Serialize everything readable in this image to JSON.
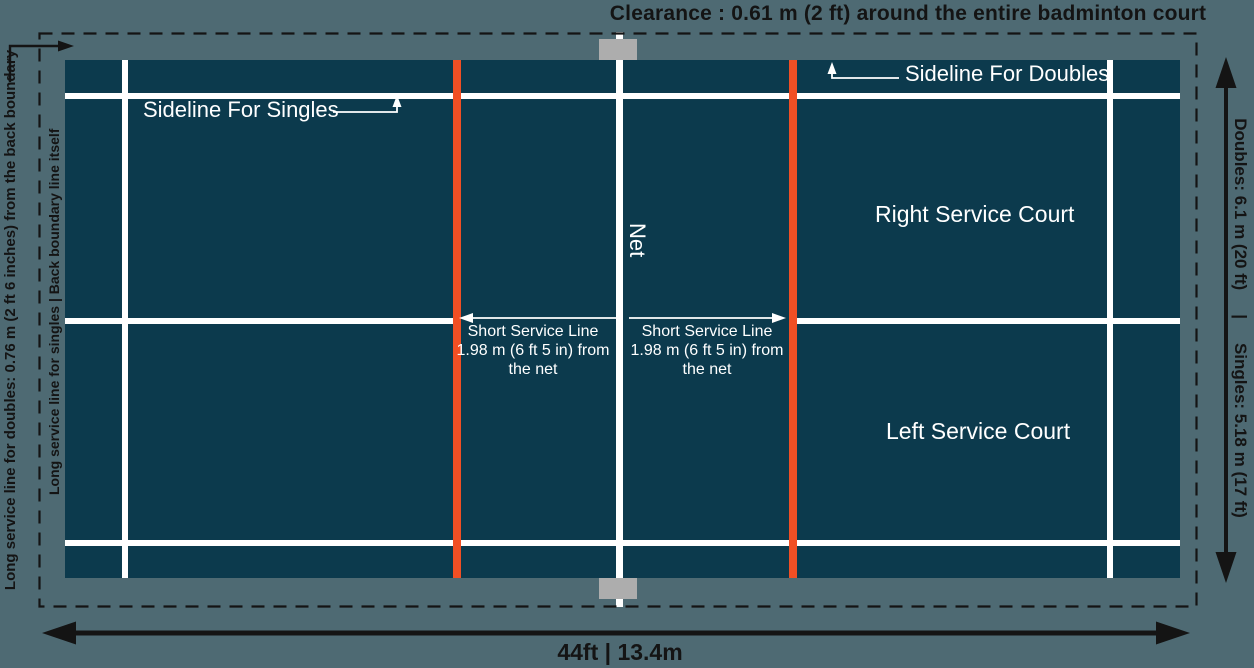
{
  "title": "Clearance : 0.61 m (2 ft) around the entire badminton court",
  "court": {
    "sideline_doubles_label": "Sideline For Doubles",
    "sideline_singles_label": "Sideline For Singles",
    "net_label": "Net",
    "right_service_court_label": "Right Service Court",
    "left_service_court_label": "Left Service Court",
    "short_service_line": {
      "line1": "Short Service Line",
      "line2": "1.98 m (6 ft 5 in) from",
      "line3": "the net"
    }
  },
  "left_annotations": {
    "long_service_doubles": "Long service line for doubles: 0.76 m (2 ft 6 inches) from the back boundary",
    "long_service_singles": "Long service line for singles | Back boundary line itself"
  },
  "right_annotation": {
    "doubles": "Doubles: 6.1 m (20 ft)",
    "separator": "|",
    "singles": "Singles: 5.18 m (17 ft)"
  },
  "bottom_annotation": {
    "width_label": "44ft | 13.4m"
  },
  "colors": {
    "background": "#4e6a73",
    "court_fill": "#0c3a4d",
    "court_line": "#ffffff",
    "short_service_line_color": "#f14f24",
    "net_post": "#adadad",
    "annotation_text": "#141414"
  }
}
